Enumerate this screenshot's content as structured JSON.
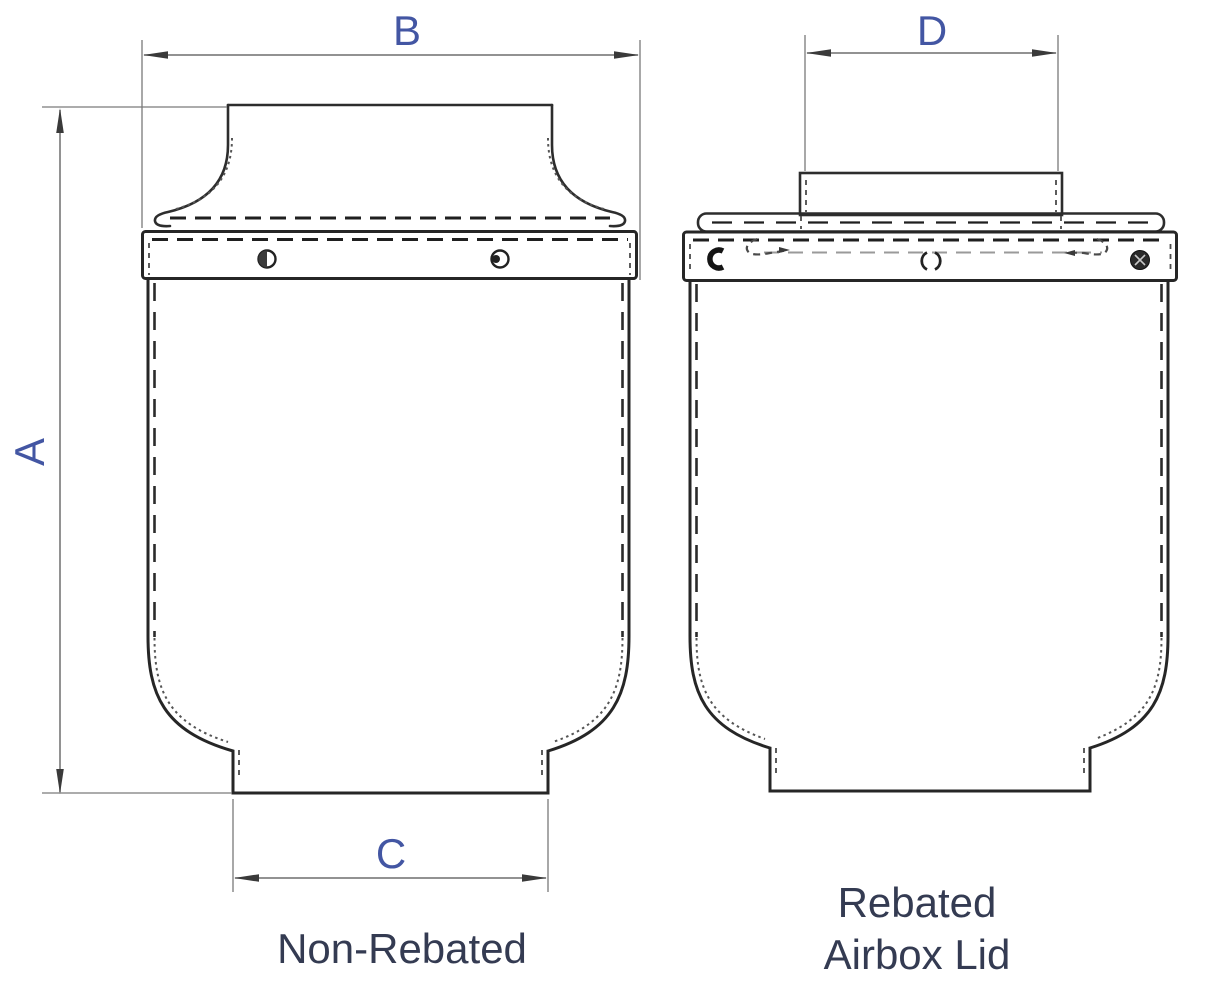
{
  "views": {
    "non_rebated": {
      "caption": "Non-Rebated",
      "dimensions": {
        "height_label": "A",
        "top_width_label": "B",
        "bottom_width_label": "C"
      }
    },
    "rebated": {
      "caption_line1": "Rebated",
      "caption_line2": "Airbox Lid",
      "dimensions": {
        "collar_width_label": "D"
      }
    }
  },
  "colors": {
    "background": "#ffffff",
    "drawing_line": "#2d2d2d",
    "hidden_line": "#1f1f1f",
    "dimension_line": "#6e6e6e",
    "dimension_label": "#4356a3",
    "caption_text": "#343b52"
  }
}
